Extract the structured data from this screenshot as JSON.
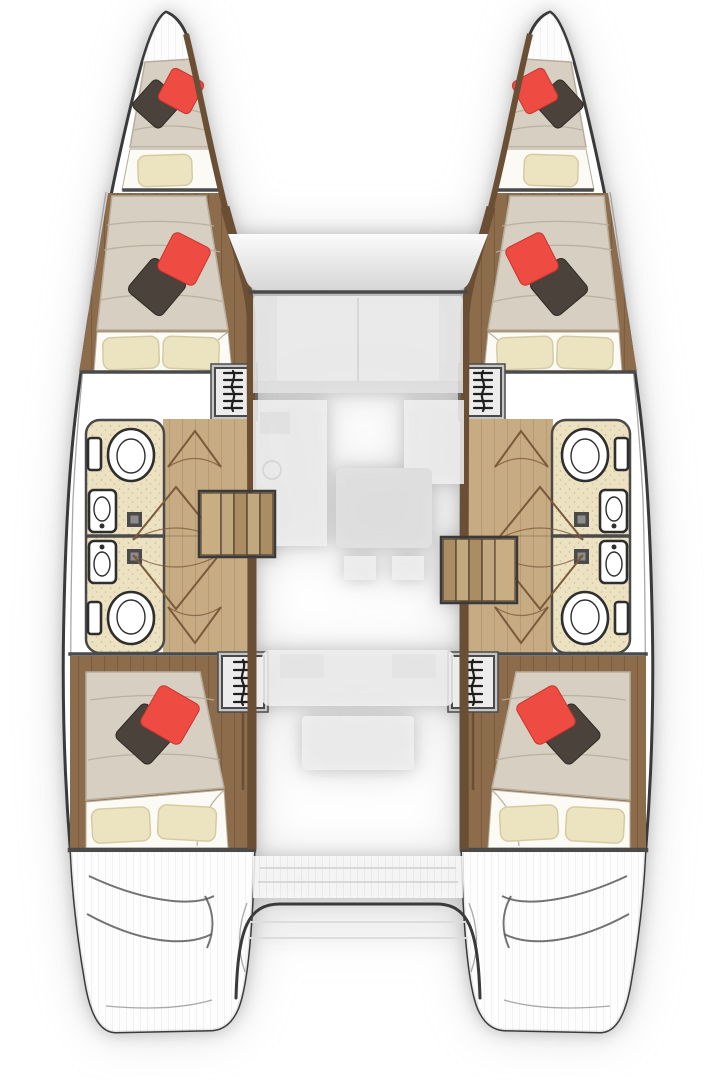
{
  "canvas": {
    "width": 720,
    "height": 1080
  },
  "diagram": {
    "kind": "catamaran-interior-floor-plan",
    "view": "top-down",
    "symmetry": "port and starboard hulls mirrored",
    "hulls": [
      {
        "id": "port",
        "side": "left",
        "rooms": [
          "bow-berth",
          "forward-cabin",
          "forward-head",
          "aft-head",
          "corridor",
          "aft-cabin",
          "stern-swim-platform"
        ]
      },
      {
        "id": "starboard",
        "side": "right",
        "rooms": [
          "bow-berth",
          "forward-cabin",
          "forward-head",
          "aft-head",
          "corridor",
          "aft-cabin",
          "stern-swim-platform"
        ]
      }
    ],
    "center": {
      "zones": [
        "foredeck-front-window",
        "saloon-ghosted",
        "galley-ghosted",
        "saloon-table-ghosted",
        "cockpit-ghosted",
        "aft-platform-arch"
      ]
    },
    "counts": {
      "v_berths": 2,
      "double_beds": 4,
      "toilets": 4,
      "sinks": 4,
      "shower_fold_doors": 4,
      "entry_staircases": 2,
      "ladder_hatches": 4,
      "red_pillows": 6,
      "dark_pillows": 6,
      "cream_pillows": 10
    }
  },
  "colors": {
    "page_bg": "#ffffff",
    "hull_fill": "#ffffff",
    "outline": "#3a3a3a",
    "wall": "#4a4a4a",
    "deck_line": "#9a9a9a",
    "wood_trim": "#6a4f35",
    "wood_floor": "#8d6c4c",
    "corridor_floor": "#c7ab82",
    "bath_floor": "#ece2c2",
    "bath_speck": "#cfc092",
    "fixture_fill": "#ffffff",
    "fixture_line": "#2e2e2e",
    "door_line": "#7a5a3a",
    "mattress": "#d6cfc2",
    "mattress_line": "#b7ad9c",
    "sheet": "#fbfaf4",
    "pillow_cream": "#ece4c1",
    "pillow_cream_line": "#d5cba2",
    "pillow_red": "#ee4b42",
    "pillow_red_dark": "#c9352e",
    "pillow_dark": "#4a423b",
    "pillow_dark_line": "#2f2a25",
    "stair_light": "#c9ad83",
    "tread_a": "#c2a87e",
    "tread_b": "#ab8d64",
    "tread_line": "#5a4733",
    "ladder_frame": "#c6c6c6",
    "ladder_fill": "#ececec",
    "ladder_line": "#1f1f1f",
    "ghost": "#f1f1f1",
    "ghost_dark": "#e3e3e3",
    "ghost_line": "#dcdcdc",
    "glass_top": "#fbfbfb",
    "glass_bottom": "#d6d6d6",
    "swim_line": "#5a5a5a"
  }
}
